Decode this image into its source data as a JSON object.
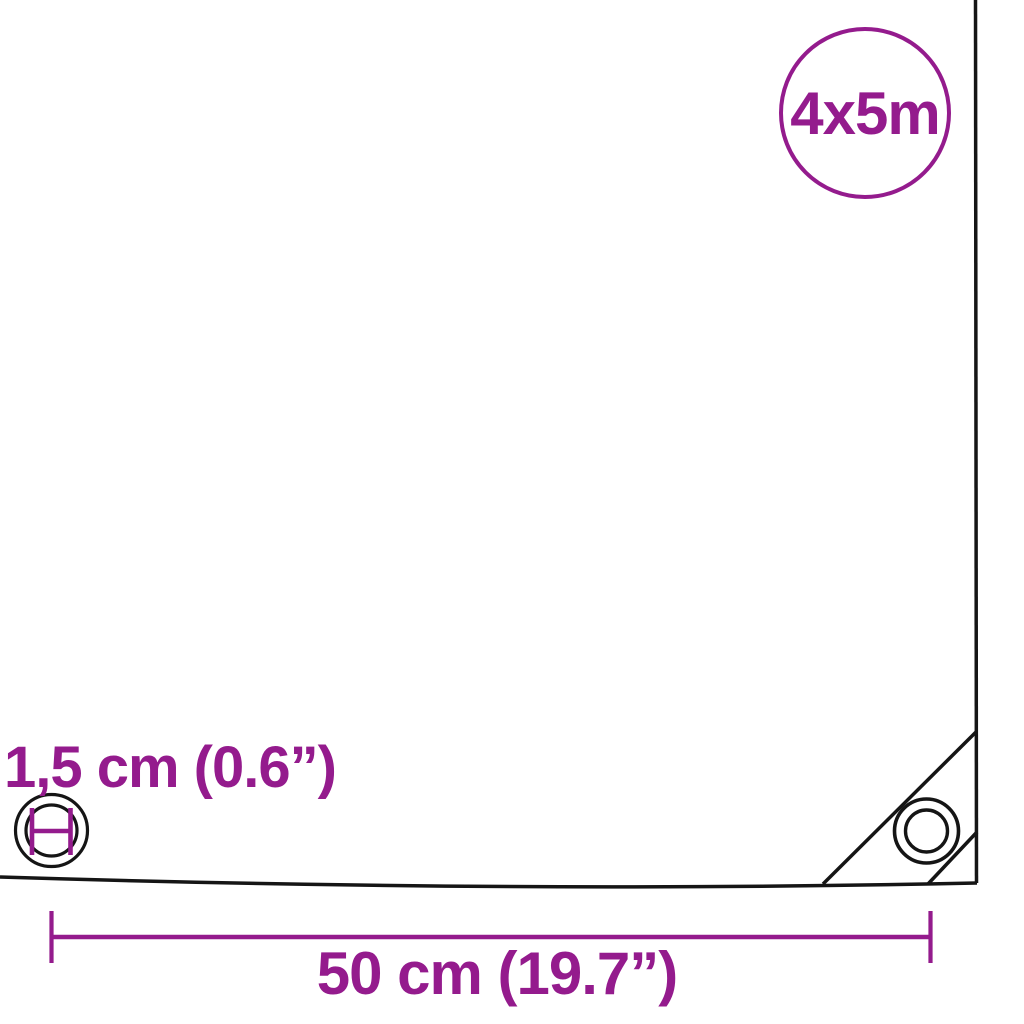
{
  "diagram": {
    "title": "tarpaulin-dimension-diagram",
    "size_badge": {
      "label": "4x5m"
    },
    "measurements": {
      "eyelet_inner_diameter": {
        "label": "1,5 cm (0.6”)"
      },
      "eyelet_spacing": {
        "label": "50 cm (19.7”)"
      }
    },
    "icons": {
      "left": "eyelet-diameter-icon",
      "right": "corner-eyelet-icon",
      "corner": "reinforced-corner-seams"
    }
  },
  "colors": {
    "accent": "#941b8d",
    "line": "#151515",
    "bg": "#ffffff"
  }
}
